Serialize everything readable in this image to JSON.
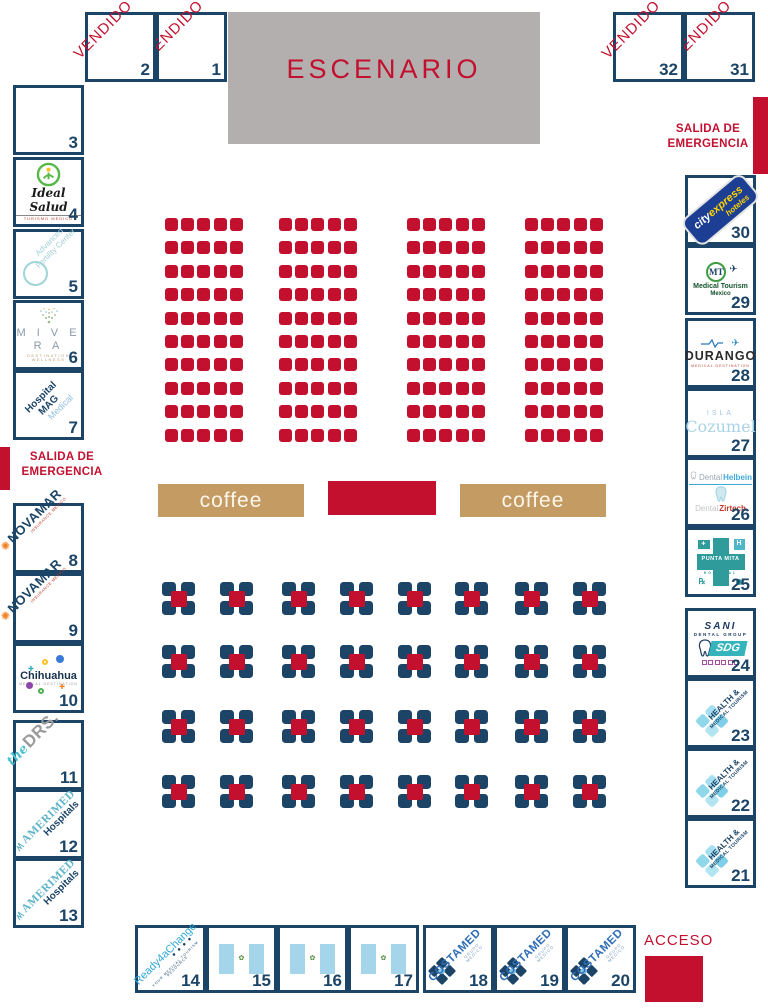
{
  "palette": {
    "red": "#c3102f",
    "navy": "#1c4467",
    "tan": "#c49b62",
    "stage_gray": "#b3afaf",
    "flag_blue": "#a5d5ea"
  },
  "stage": {
    "label": "ESCENARIO"
  },
  "coffee": {
    "label": "coffee"
  },
  "emergency_exit": {
    "line1": "SALIDA DE",
    "line2": "EMERGENCIA"
  },
  "access": {
    "label": "ACCESO"
  },
  "seating": {
    "blocks": 4,
    "rows": 10,
    "cols": 5,
    "seat_color": "#c3102f"
  },
  "tables": {
    "rows": 4,
    "cols": 8,
    "chair_color": "#1c4467",
    "table_color": "#c3102f"
  },
  "booths": [
    {
      "number": "1",
      "type": "vendido",
      "label": "VENDIDO"
    },
    {
      "number": "2",
      "type": "vendido",
      "label": "VENDIDO"
    },
    {
      "number": "3",
      "type": "empty"
    },
    {
      "number": "4",
      "type": "ideal-salud",
      "label": "Ideal Salud",
      "sub": "TURISMO MEDICO"
    },
    {
      "number": "5",
      "type": "fertility",
      "label": "Advanced Fertility Center"
    },
    {
      "number": "6",
      "type": "mivera",
      "label": "M I V E R A",
      "sub": "DESTINATION WELLNESS"
    },
    {
      "number": "7",
      "type": "mag",
      "label": "Hospital MAG",
      "sub": "Medical"
    },
    {
      "number": "8",
      "type": "novamar",
      "label": "NOVAMAR",
      "sub": "INSURANCE MEXICO"
    },
    {
      "number": "9",
      "type": "novamar",
      "label": "NOVAMAR",
      "sub": "INSURANCE MEXICO"
    },
    {
      "number": "10",
      "type": "chihuahua",
      "label": "Chihuahua",
      "sub": "MEDICAL DESTINATION"
    },
    {
      "number": "11",
      "type": "drs",
      "pre": "the",
      "label": "DRS."
    },
    {
      "number": "12",
      "type": "amerimed",
      "label": "AMERIMED",
      "sub": "Hospitals"
    },
    {
      "number": "13",
      "type": "amerimed",
      "label": "AMERIMED",
      "sub": "Hospitals"
    },
    {
      "number": "14",
      "type": "ready",
      "label": "Ready4aChange",
      "sub": "YOUR MEDICAL TOURISM RESOURCE"
    },
    {
      "number": "15",
      "type": "flag"
    },
    {
      "number": "16",
      "type": "flag"
    },
    {
      "number": "17",
      "type": "flag"
    },
    {
      "number": "18",
      "type": "costamed",
      "label": "COSTAMED",
      "sub": "GRUPO MEDICO"
    },
    {
      "number": "19",
      "type": "costamed",
      "label": "COSTAMED",
      "sub": "GRUPO MEDICO"
    },
    {
      "number": "20",
      "type": "costamed",
      "label": "COSTAMED",
      "sub": "GRUPO MEDICO"
    },
    {
      "number": "21",
      "type": "health",
      "label": "HEALTH &",
      "sub": "MEDICAL TOURISM"
    },
    {
      "number": "22",
      "type": "health",
      "label": "HEALTH &",
      "sub": "MEDICAL TOURISM"
    },
    {
      "number": "23",
      "type": "health",
      "label": "HEALTH &",
      "sub": "MEDICAL TOURISM"
    },
    {
      "number": "24",
      "type": "sani",
      "label": "SANI",
      "sub": "DENTAL GROUP",
      "mark": "SDG"
    },
    {
      "number": "25",
      "type": "punta",
      "label": "PUNTA MITA",
      "sub": "HOSPITAL",
      "mark": "H"
    },
    {
      "number": "26",
      "type": "dental",
      "label": "Dental",
      "label2": "Helbein",
      "label3": "Dental",
      "label4": "Zirtech"
    },
    {
      "number": "27",
      "type": "cozumel",
      "pre": "ISLA",
      "label": "Cozumel"
    },
    {
      "number": "28",
      "type": "durango",
      "label": "DURANGO",
      "sub": "MEDICAL DESTINATION"
    },
    {
      "number": "29",
      "type": "mtm",
      "mark": "MT",
      "label": "Medical Tourism",
      "sub": "Mexico"
    },
    {
      "number": "30",
      "type": "cityexpress",
      "label": "city",
      "label2": "express",
      "label3": "hoteles"
    },
    {
      "number": "31",
      "type": "vendido",
      "label": "VENDIDO"
    },
    {
      "number": "32",
      "type": "vendido",
      "label": "VENDIDO"
    }
  ]
}
